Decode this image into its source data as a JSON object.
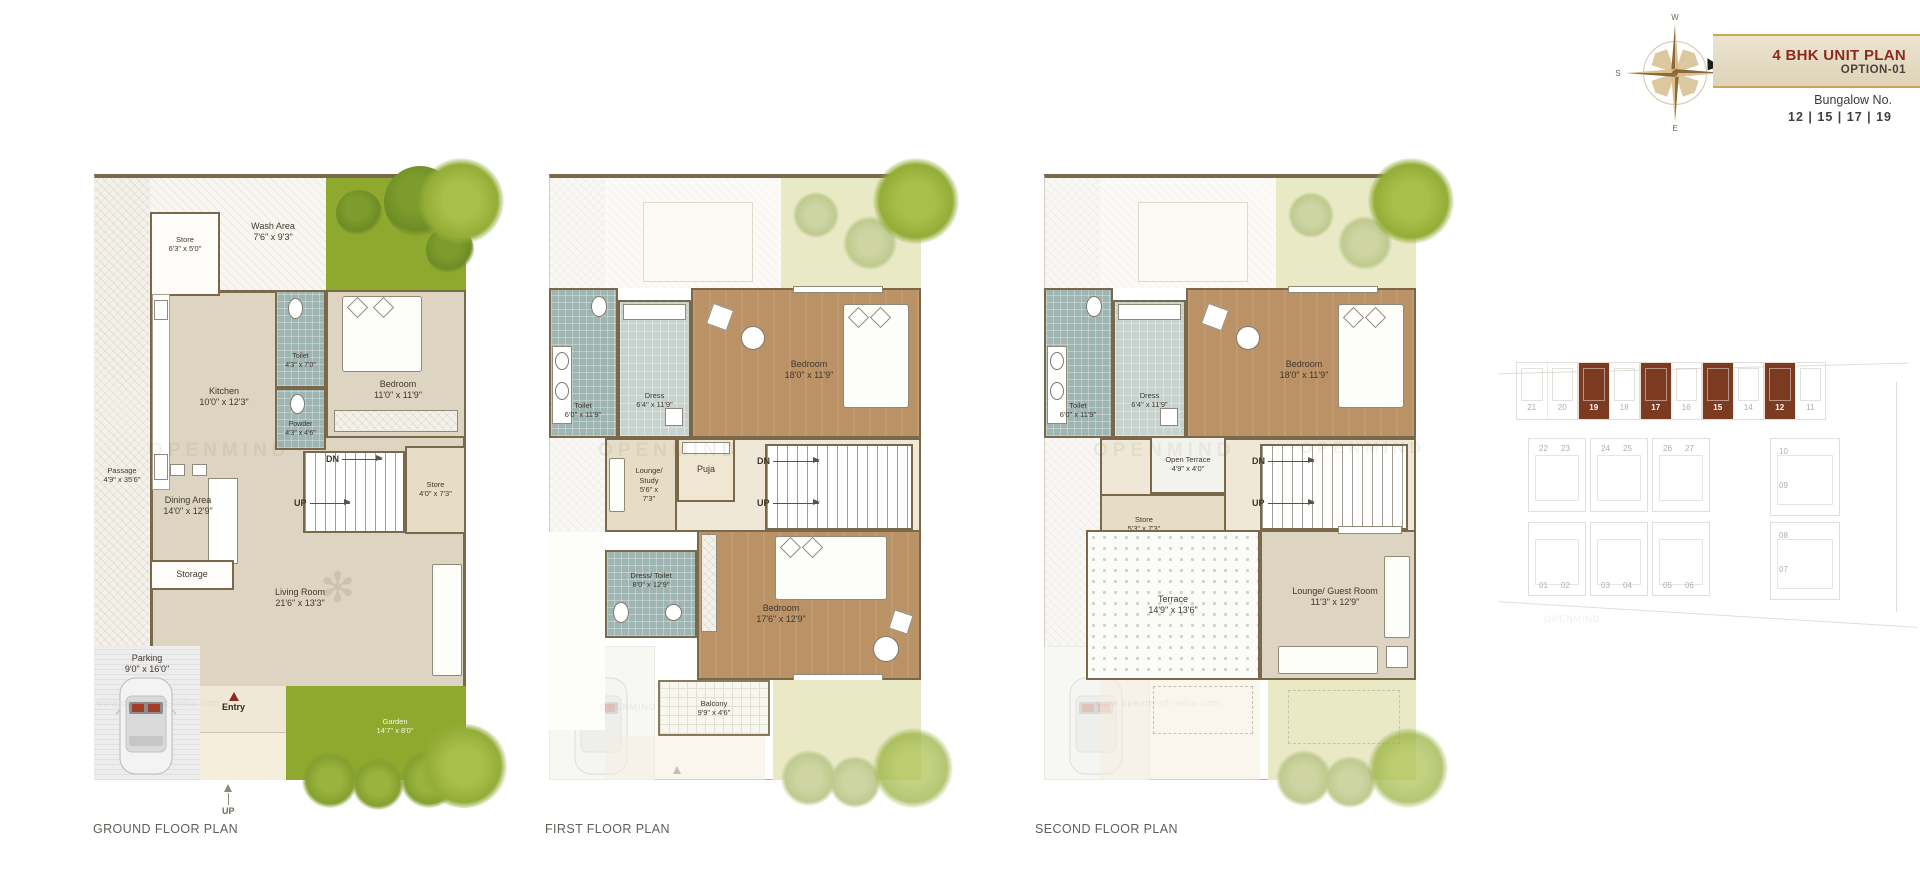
{
  "header": {
    "title": "4 BHK UNIT PLAN",
    "subtitle": "OPTION-01",
    "bungalow_label": "Bungalow No.",
    "bungalow_numbers": "12  |  15  |  17  |  19"
  },
  "compass": {
    "n": "N",
    "e": "E",
    "s": "S",
    "w": "W"
  },
  "watermark": {
    "brand": "OPENMIND",
    "url": "www.openmind-india.com"
  },
  "ground": {
    "title": "GROUND FLOOR PLAN",
    "passage": {
      "name": "Passage",
      "dim": "4'9\" x 35'6\""
    },
    "wash": {
      "name": "Wash Area",
      "dim": "7'6\" x 9'3\""
    },
    "store1": {
      "name": "Store",
      "dim": "6'3\" x 5'0\""
    },
    "kitchen": {
      "name": "Kitchen",
      "dim": "10'0\" x 12'3\""
    },
    "toilet": {
      "name": "Toilet",
      "dim": "4'3\" x 7'0\""
    },
    "powder": {
      "name": "Powder",
      "dim": "4'3\" x 4'6\""
    },
    "bedroom": {
      "name": "Bedroom",
      "dim": "11'0\" x 11'9\""
    },
    "dn": "DN",
    "up": "UP",
    "store2": {
      "name": "Store",
      "dim": "4'0\" x 7'3\""
    },
    "dining": {
      "name": "Dining Area",
      "dim": "14'0\" x 12'9\""
    },
    "storage": {
      "name": "Storage"
    },
    "living": {
      "name": "Living Room",
      "dim": "21'6\" x 13'3\""
    },
    "parking": {
      "name": "Parking",
      "dim": "9'0\" x 16'0\""
    },
    "entry": "Entry",
    "garden": {
      "name": "Garden",
      "dim": "14'7\" x 8'0\""
    },
    "up_outside": "UP"
  },
  "first": {
    "title": "FIRST FLOOR PLAN",
    "toilet": {
      "name": "Toilet",
      "dim": "6'0\" x 11'9\""
    },
    "dress": {
      "name": "Dress",
      "dim": "6'4\" x 11'9\""
    },
    "bedroom1": {
      "name": "Bedroom",
      "dim": "18'0\" x 11'9\""
    },
    "lounge": {
      "l1": "Lounge/",
      "l2": "Study",
      "l3": "5'6\" x",
      "l4": "7'3\""
    },
    "puja": {
      "name": "Puja"
    },
    "dn": "DN",
    "up": "UP",
    "dresstoilet": {
      "name": "Dress/ Toilet",
      "dim": "8'0\" x 12'9\""
    },
    "bedroom2": {
      "name": "Bedroom",
      "dim": "17'6\" x 12'9\""
    },
    "balcony": {
      "name": "Balcony",
      "dim": "9'9\" x 4'6\""
    }
  },
  "second": {
    "title": "SECOND FLOOR PLAN",
    "toilet": {
      "name": "Toilet",
      "dim": "6'0\" x 11'9\""
    },
    "dress": {
      "name": "Dress",
      "dim": "6'4\" x 11'9\""
    },
    "bedroom1": {
      "name": "Bedroom",
      "dim": "18'0\" x 11'9\""
    },
    "openterrace": {
      "name": "Open Terrace",
      "dim": "4'9\" x 4'0\""
    },
    "store": {
      "name": "Store",
      "dim": "5'3\" x 7'3\""
    },
    "dn": "DN",
    "up": "UP",
    "terrace": {
      "name": "Terrace",
      "dim": "14'9\" x 13'6\""
    },
    "lounge": {
      "name": "Lounge/ Guest Room",
      "dim": "11'3\" x 12'9\""
    }
  },
  "site": {
    "row1": [
      "21",
      "20",
      "19",
      "18",
      "17",
      "16",
      "15",
      "14",
      "12",
      "11"
    ],
    "row2": [
      "22",
      "23",
      "24",
      "25",
      "26",
      "27"
    ],
    "row3": [
      "01",
      "02",
      "03",
      "04",
      "05",
      "06"
    ],
    "colA": [
      "10",
      "09"
    ],
    "colB": [
      "08",
      "07"
    ],
    "highlight_color": "#7c3a21"
  }
}
